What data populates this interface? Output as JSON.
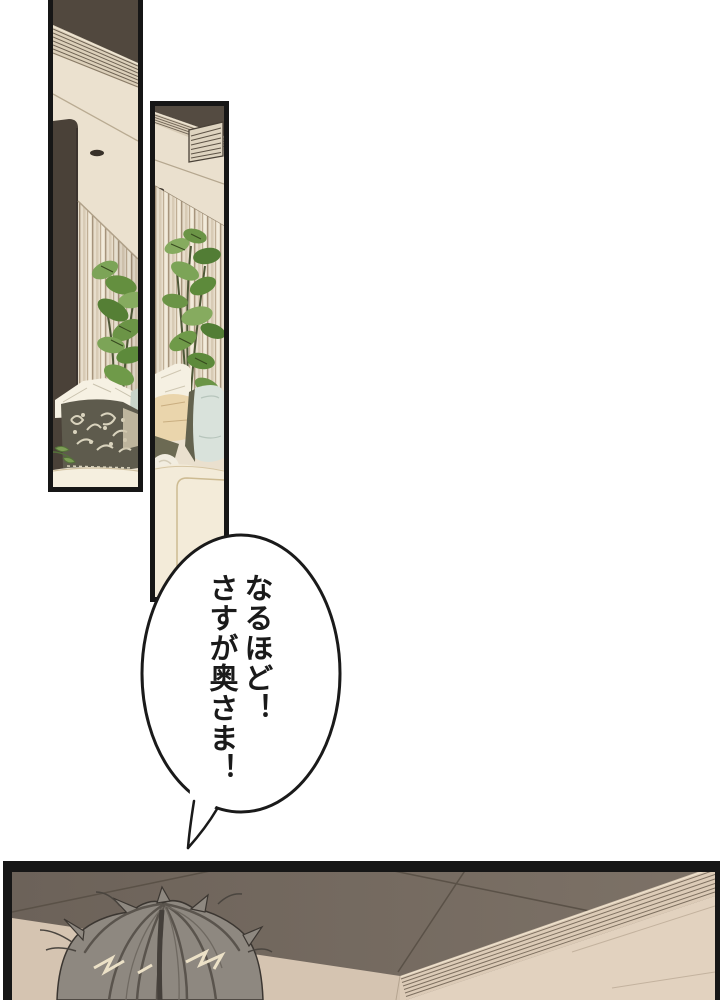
{
  "speech_bubble": {
    "lines": [
      "なるほど！",
      "さすが奥さま！"
    ],
    "full_text": "なるほど！さすが奥さま！",
    "reading_direction": "vertical-right-to-left",
    "fill": "#ffffff",
    "outline_color": "#1a1a1a",
    "text_color": "#1a1a1a"
  },
  "panels": [
    {
      "id": "panel-1",
      "description": "Tall left panel: living-room corner with dark wood column, slatted ceiling cornice, recessed light, striped curtains, green plant, white and dark damask pillows on a cream sofa"
    },
    {
      "id": "panel-2",
      "description": "Tall middle panel: ceiling with air vent and recessed light, striped curtains, large green houseplant, white, tan and pale-blue pillows, cream sofa arm"
    },
    {
      "id": "panel-3",
      "description": "Wide bottom panel: grey-brown ceiling corner with slatted cornice and tan walls; back of a person's head with grey hair seen from above"
    }
  ],
  "colors": {
    "page_background": "#ffffff",
    "panel_border": "#161616",
    "ceiling_dark_brown": "#51483e",
    "ceiling_cream": "#ebe1cf",
    "curtain_base": "#e7ddcb",
    "plant_green": "#6b9446",
    "pillow_damask_dark": "#5e5b4d",
    "pillow_blue": "#d9e2db",
    "pillow_tan": "#ead5ac",
    "sofa_cream": "#f4ecda",
    "bottom_ceiling_grey": "#6f655b",
    "wall_tan": "#d5c4b1",
    "hair_grey": "#8e8880",
    "hair_highlight": "#ece1c7"
  }
}
